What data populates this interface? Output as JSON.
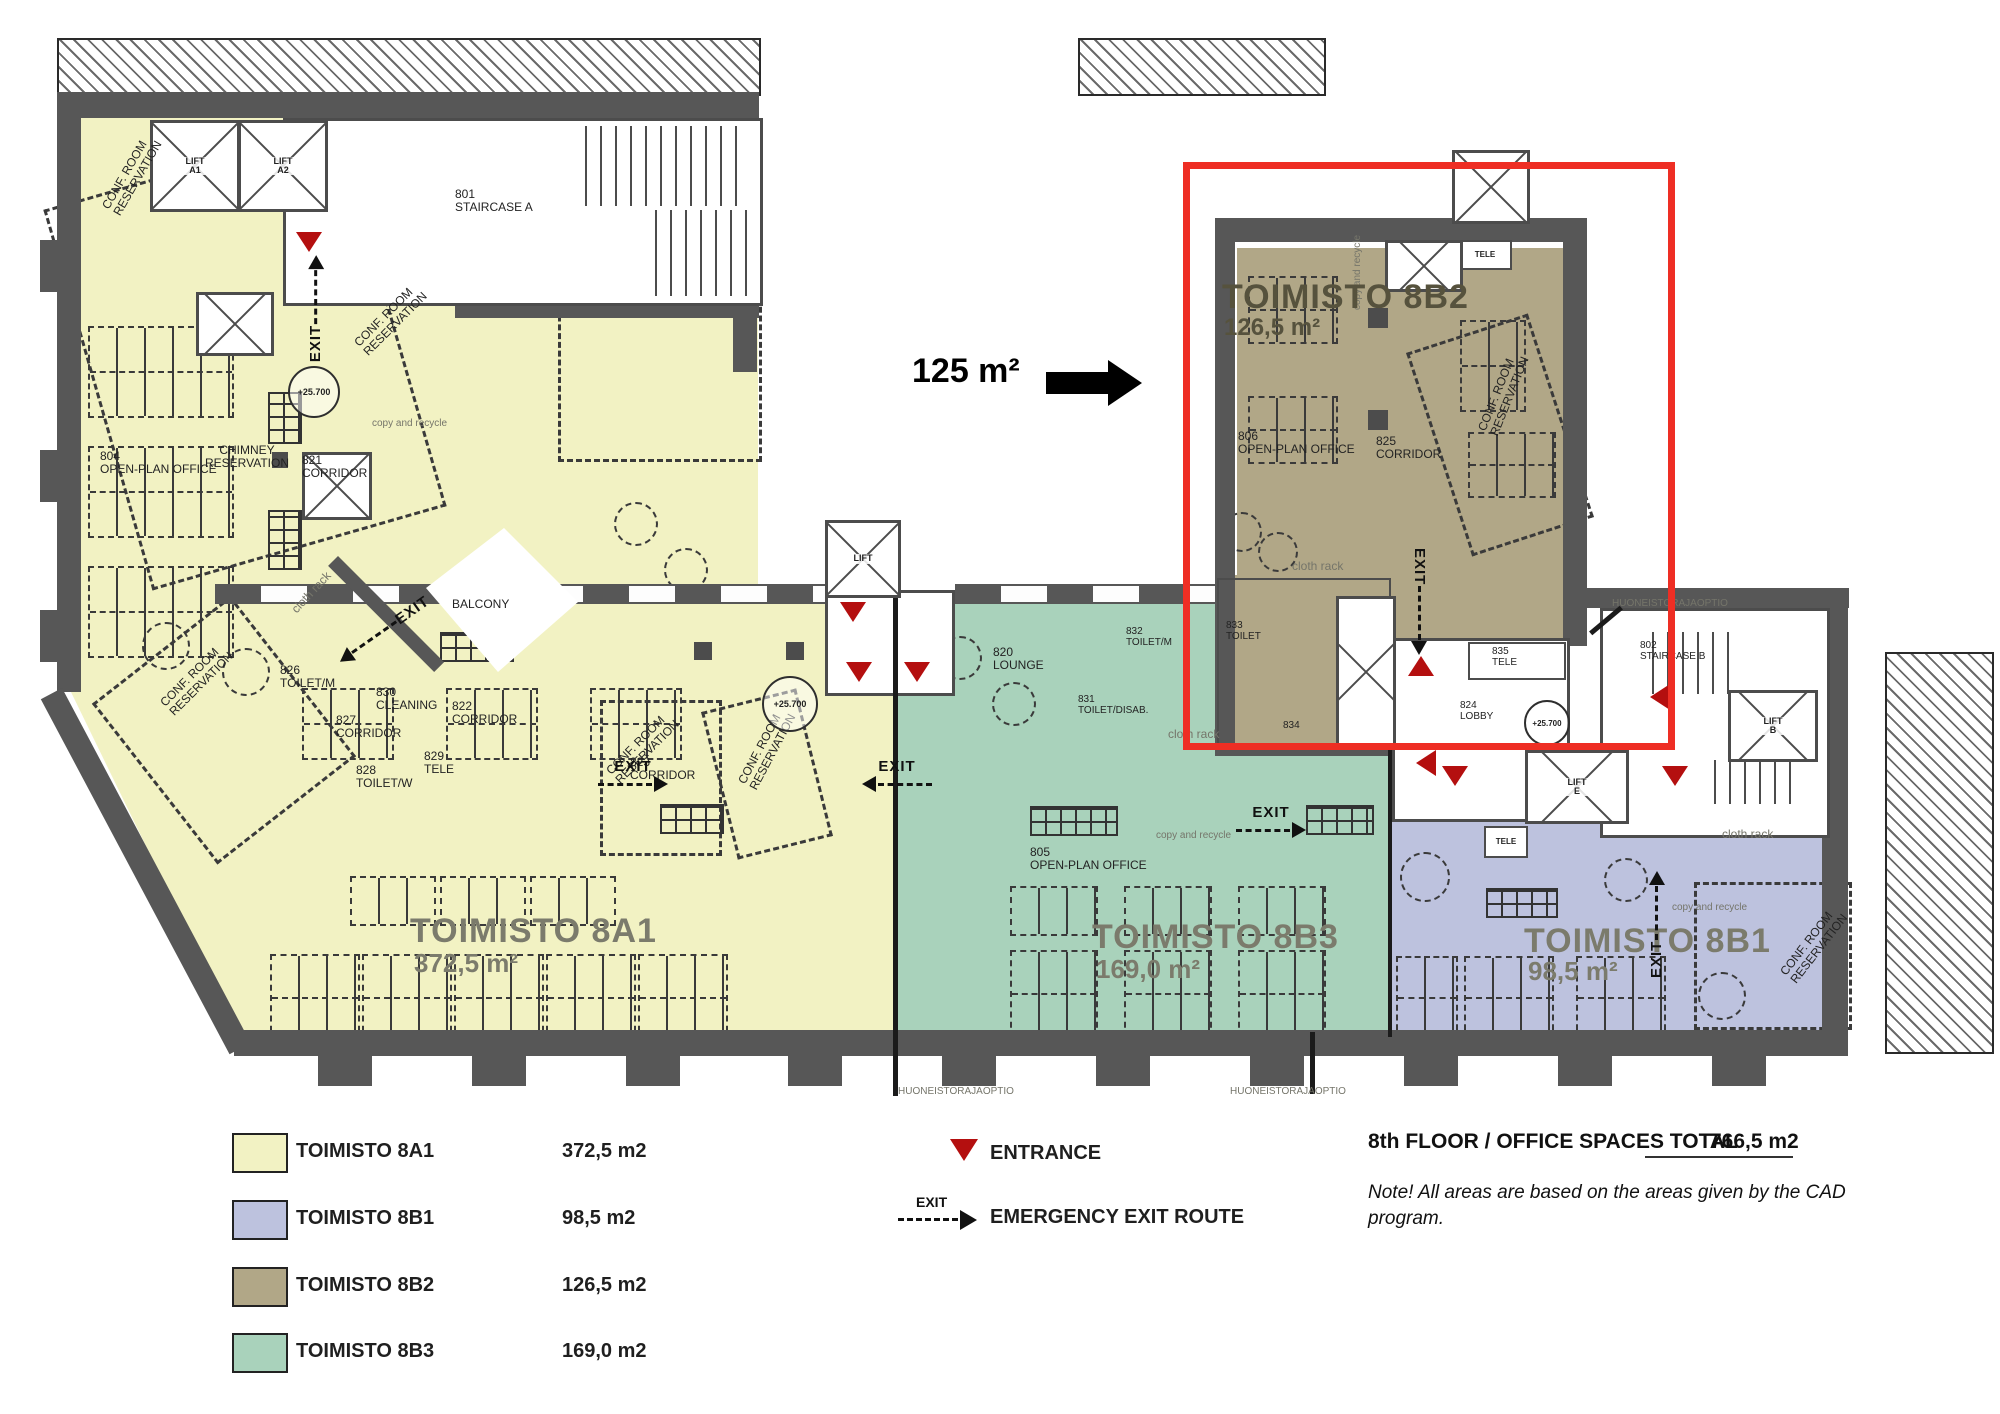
{
  "annotation": {
    "area": "125 m²"
  },
  "zones": {
    "a1": {
      "name": "TOIMISTO 8A1",
      "area": "372,5 m²"
    },
    "b1": {
      "name": "TOIMISTO 8B1",
      "area": "98,5 m²"
    },
    "b2": {
      "name": "TOIMISTO 8B2",
      "area": "126,5 m²"
    },
    "b3": {
      "name": "TOIMISTO 8B3",
      "area": "169,0 m²"
    }
  },
  "rooms": {
    "staircase_a": "801\nSTAIRCASE A",
    "staircase_b": "802\nSTAIRCASE B",
    "open_plan_804": "804\nOPEN-PLAN OFFICE",
    "open_plan_805": "805\nOPEN-PLAN OFFICE",
    "open_plan_806": "806\nOPEN-PLAN OFFICE",
    "corridor_821": "821\nCORRIDOR",
    "corridor_822": "822\nCORRIDOR",
    "corridor_823": "823\nCORRIDOR",
    "corridor_825": "825\nCORRIDOR",
    "corridor_827": "827\nCORRIDOR",
    "lounge_820": "820\nLOUNGE",
    "lobby_824": "824\nLOBBY",
    "toilet_826": "826\nTOILET/M",
    "toilet_828": "828\nTOILET/W",
    "tele_829": "829\nTELE",
    "cleaning_830": "830\nCLEANING",
    "toilet_831": "831\nTOILET/DISAB.",
    "toilet_832": "832\nTOILET/M",
    "toilet_833": "833\nTOILET",
    "room_834": "834",
    "tele_835": "835\nTELE",
    "chimney": "CHIMNEY\nRESERVATION",
    "balcony": "BALCONY",
    "lift": "LIFT",
    "lift_a1": "LIFT\nA1",
    "lift_a2": "LIFT\nA2",
    "lift_b": "LIFT\nB",
    "lift_e": "LIFT\nE",
    "tele": "TELE"
  },
  "markers": {
    "exit": "EXIT",
    "level": "+25.700",
    "cloth_rack": "cloth rack",
    "copy_recycle": "copy and recycle",
    "conf_reservation": "CONF. ROOM\nRESERVATION",
    "boundary": "HUONEISTORAJAOPTIO"
  },
  "legend": {
    "items": [
      {
        "label": "TOIMISTO 8A1",
        "area": "372,5 m2",
        "color": "#f2f2c3"
      },
      {
        "label": "TOIMISTO 8B1",
        "area": "98,5 m2",
        "color": "#bdc2de"
      },
      {
        "label": "TOIMISTO 8B2",
        "area": "126,5 m2",
        "color": "#b1a787"
      },
      {
        "label": "TOIMISTO 8B3",
        "area": "169,0 m2",
        "color": "#a9d2bb"
      }
    ],
    "entrance": "ENTRANCE",
    "exit_symbol": "EXIT",
    "emergency": "EMERGENCY EXIT ROUTE"
  },
  "summary": {
    "total_label": "8th FLOOR / OFFICE SPACES TOTAL",
    "total_value": "766,5 m2",
    "note": "Note! All areas are based on the areas given by the CAD\nprogram."
  }
}
